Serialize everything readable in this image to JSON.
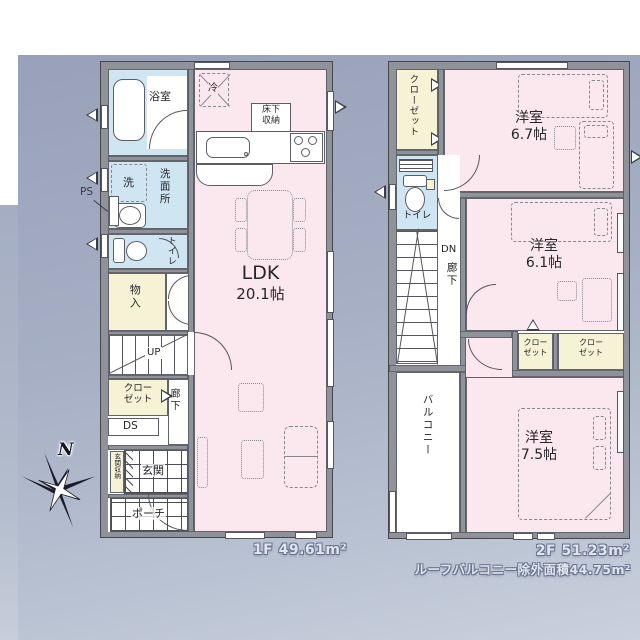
{
  "palette": {
    "wall": "#90929a",
    "room_pink": "#fbe8ee",
    "room_blue": "#cfe5f2",
    "room_cream": "#f6f2d5",
    "backdrop": "#a6afc4"
  },
  "compass": {
    "north": "N"
  },
  "floor1": {
    "area_label": "1F 49.61m²",
    "bath": "浴室",
    "laundry": "洗",
    "washroom": "洗面所",
    "ps": "PS",
    "toilet": "トイレ",
    "storage": "物入",
    "stairs_up": "UP",
    "closet_l1": "クロー",
    "closet_l2": "ゼット",
    "duct": "DS",
    "hallway": "廊下",
    "entrance_storage": "玄関収納",
    "entrance": "玄関",
    "porch": "ポーチ",
    "fridge": "冷",
    "underfloor_l1": "床下",
    "underfloor_l2": "収納",
    "ldk_name": "LDK",
    "ldk_size": "20.1帖"
  },
  "floor2": {
    "area_label": "2F 51.23m²",
    "roof_note": "ルーフバルコニー除外面積44.75m²",
    "closet": "クローゼット",
    "toilet": "トイレ",
    "stairs_dn": "DN",
    "hallway": "廊下",
    "room1_name": "洋室",
    "room1_size": "6.7帖",
    "room2_name": "洋室",
    "room2_size": "6.1帖",
    "room3_name": "洋室",
    "room3_size": "7.5帖",
    "closet_a_l1": "クロー",
    "closet_a_l2": "ゼット",
    "closet_b_l1": "クロー",
    "closet_b_l2": "ゼット",
    "balcony": "バルコニー"
  }
}
